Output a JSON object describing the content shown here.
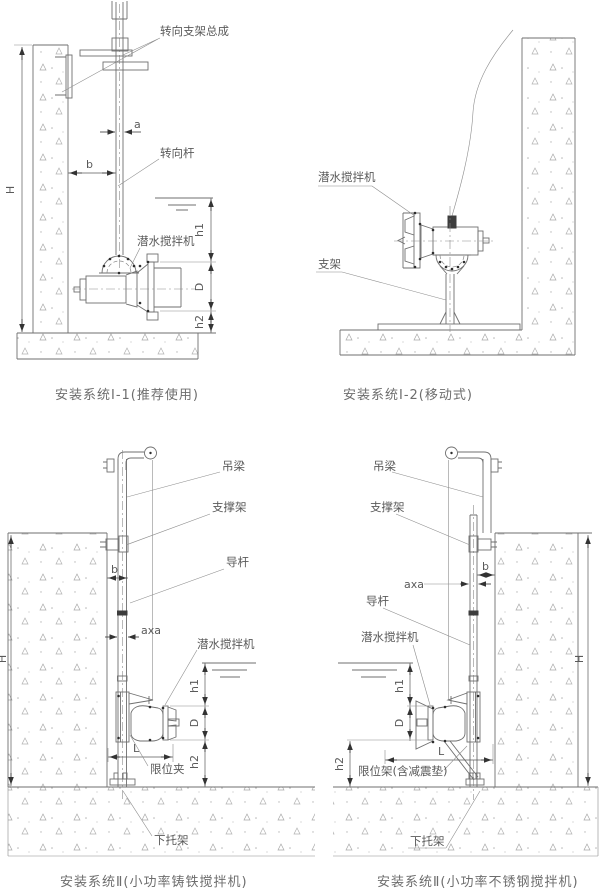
{
  "drawing": {
    "colors": {
      "line": "#6f6f6f",
      "dimension": "#5a5a5a",
      "text": "#5a5a5a",
      "hatch": "#a8a8a8"
    },
    "d1": {
      "caption": "安装系统Ⅰ-1(推荐使用)",
      "labels": {
        "steering_bracket_assembly": "转向支架总成",
        "steering_rod": "转向杆",
        "submersible_mixer": "潜水搅拌机"
      },
      "dims": {
        "H": "H",
        "a": "a",
        "b": "b",
        "h1": "h1",
        "D": "D",
        "h2": "h2"
      }
    },
    "d2": {
      "caption": "安装系统Ⅰ-2(移动式)",
      "labels": {
        "submersible_mixer": "潜水搅拌机",
        "stand": "支架"
      }
    },
    "d3": {
      "caption": "安装系统Ⅱ(小功率铸铁搅拌机)",
      "labels": {
        "hanger_beam": "吊梁",
        "support_frame": "支撑架",
        "guide_rod": "导杆",
        "submersible_mixer": "潜水搅拌机",
        "limit_clamp": "限位夹",
        "lower_bracket": "下托架"
      },
      "dims": {
        "H": "H",
        "b": "b",
        "axa": "axa",
        "L": "L",
        "h1": "h1",
        "D": "D",
        "h2": "h2"
      }
    },
    "d4": {
      "caption": "安装系统Ⅱ(小功率不锈钢搅拌机)",
      "labels": {
        "hanger_beam": "吊梁",
        "support_frame": "支撑架",
        "guide_rod": "导杆",
        "submersible_mixer": "潜水搅拌机",
        "limit_frame": "限位架(含减震垫)",
        "lower_bracket": "下托架"
      },
      "dims": {
        "H": "H",
        "b": "b",
        "axa": "axa",
        "L": "L",
        "h1": "h1",
        "D": "D",
        "h2": "h2"
      }
    }
  }
}
